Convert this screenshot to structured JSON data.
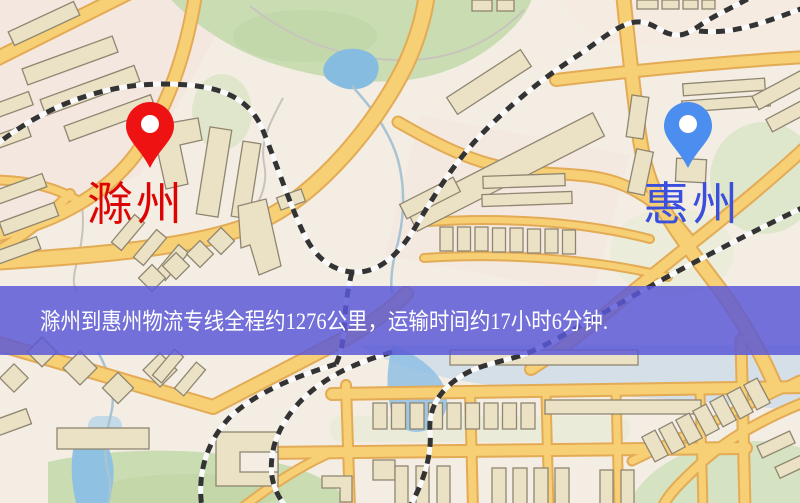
{
  "map": {
    "origin_marker": {
      "label": "滁州",
      "pin_color": "#ee1312",
      "label_color": "#dd0404"
    },
    "destination_marker": {
      "label": "惠州",
      "pin_color": "#4b8ef0",
      "label_color": "#3a50dc"
    },
    "palette": {
      "base": "#f4ede3",
      "road": "#f7cf74",
      "road_casing": "#e3ab55",
      "park": "#c9dcb2",
      "water": "#85bce0",
      "building": "#ebe1c4",
      "building_outline": "#8f8672",
      "railway": "#333333",
      "pink_district": "#f6dfdb"
    }
  },
  "banner": {
    "text": "滁州到惠州物流专线全程约1276公里，运输时间约17小时6分钟.",
    "bg_color": "#5a58d6",
    "text_color": "#ffffff"
  }
}
